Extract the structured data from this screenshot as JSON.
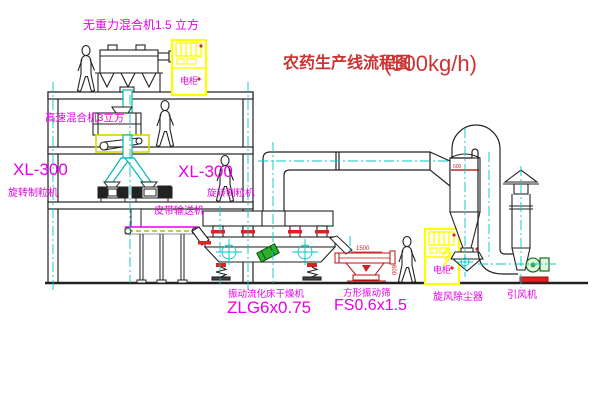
{
  "title": {
    "text": "农药生产线流程图",
    "capacity": "(500kg/h)"
  },
  "labels": {
    "top_mixer": "无重力混合机1.5 立方",
    "mid_mixer": "高速混合机3立方",
    "granulator_left_model": "XL-300",
    "granulator_left_name": "旋转制粒机",
    "granulator_right_model": "XL-300",
    "granulator_right_name": "旋转制粒机",
    "belt_conveyor": "皮带输送机",
    "dryer_name": "振动流化床干燥机",
    "dryer_model": "ZLG6x0.75",
    "screen_name": "方形振动筛",
    "screen_model": "FS0.6x1.5",
    "cyclone_name": "旋风除尘器",
    "fan_name": "引风机",
    "cabinet_text": "电柜",
    "dim_length": "1500",
    "dim_width": "600",
    "cyclone_dim": "600"
  },
  "colors": {
    "label_magenta": "#e800e8",
    "title_red": "#cc3333",
    "machine_red": "#bb1111",
    "accent_red": "#dd2222",
    "cabinet_yellow": "#ffff00",
    "centerline_cyan": "#00c8c8",
    "pipe_teal": "#00b8b8",
    "motor_green": "#2fae2f",
    "line_black": "#222222"
  }
}
